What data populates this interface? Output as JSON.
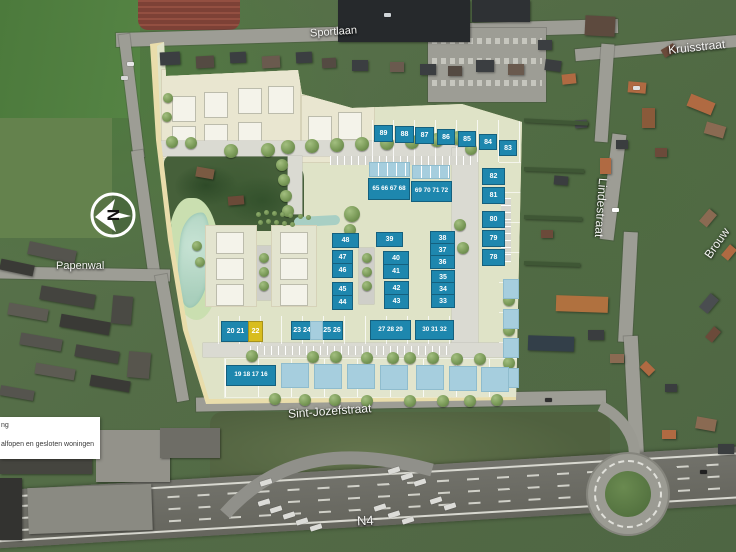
{
  "streets": {
    "sportlaan": "Sportlaan",
    "kruisstraat": "Kruisstraat",
    "lindestraat": "Lindestraat",
    "brouw": "Brouw",
    "papenwal": "Papenwal",
    "sint_jozefstraat": "Sint-Jozefstraat",
    "n4": "N4"
  },
  "north_arrow": {
    "letter": "N"
  },
  "legend": {
    "line1_partial": "ng",
    "line2_partial": "alfopen en gesloten woningen"
  },
  "colors": {
    "available": "#1e87ae",
    "option": "#d8bd1e",
    "reserved": "#a6cede",
    "plan_background": "#dfe3c7",
    "plan_border": "#e9ddab"
  },
  "lots": [
    {
      "label": "89",
      "status": "available",
      "x": 374,
      "y": 125,
      "w": 17,
      "h": 15
    },
    {
      "label": "88",
      "status": "available",
      "x": 395,
      "y": 126,
      "w": 17,
      "h": 15
    },
    {
      "label": "87",
      "status": "available",
      "x": 415,
      "y": 127,
      "w": 17,
      "h": 15
    },
    {
      "label": "86",
      "status": "available",
      "x": 437,
      "y": 129,
      "w": 16,
      "h": 14
    },
    {
      "label": "85",
      "status": "available",
      "x": 458,
      "y": 131,
      "w": 16,
      "h": 14
    },
    {
      "label": "84",
      "status": "available",
      "x": 479,
      "y": 134,
      "w": 16,
      "h": 14
    },
    {
      "label": "83",
      "status": "available",
      "x": 499,
      "y": 140,
      "w": 16,
      "h": 14
    },
    {
      "label": "82",
      "status": "available",
      "x": 482,
      "y": 168,
      "w": 21,
      "h": 15
    },
    {
      "label": "81",
      "status": "available",
      "x": 482,
      "y": 187,
      "w": 21,
      "h": 15
    },
    {
      "label": "80",
      "status": "available",
      "x": 482,
      "y": 211,
      "w": 21,
      "h": 15
    },
    {
      "label": "79",
      "status": "available",
      "x": 482,
      "y": 230,
      "w": 21,
      "h": 15
    },
    {
      "label": "78",
      "status": "available",
      "x": 482,
      "y": 249,
      "w": 21,
      "h": 15
    },
    {
      "label": "65 66 67 68",
      "status": "available",
      "x": 368,
      "y": 178,
      "w": 40,
      "h": 20
    },
    {
      "label": "69 70 71 72",
      "status": "available",
      "x": 411,
      "y": 181,
      "w": 39,
      "h": 19
    },
    {
      "label": "48",
      "status": "available",
      "x": 332,
      "y": 233,
      "w": 25,
      "h": 13
    },
    {
      "label": "39",
      "status": "available",
      "x": 376,
      "y": 232,
      "w": 25,
      "h": 13
    },
    {
      "label": "38",
      "status": "available",
      "x": 430,
      "y": 231,
      "w": 23,
      "h": 12
    },
    {
      "label": "37",
      "status": "available",
      "x": 430,
      "y": 243,
      "w": 23,
      "h": 12
    },
    {
      "label": "36",
      "status": "available",
      "x": 430,
      "y": 255,
      "w": 23,
      "h": 12
    },
    {
      "label": "47",
      "status": "available",
      "x": 332,
      "y": 250,
      "w": 19,
      "h": 13
    },
    {
      "label": "46",
      "status": "available",
      "x": 332,
      "y": 263,
      "w": 19,
      "h": 13
    },
    {
      "label": "40",
      "status": "available",
      "x": 383,
      "y": 251,
      "w": 24,
      "h": 13
    },
    {
      "label": "41",
      "status": "available",
      "x": 383,
      "y": 264,
      "w": 24,
      "h": 13
    },
    {
      "label": "45",
      "status": "available",
      "x": 332,
      "y": 282,
      "w": 19,
      "h": 13
    },
    {
      "label": "44",
      "status": "available",
      "x": 332,
      "y": 295,
      "w": 19,
      "h": 13
    },
    {
      "label": "42",
      "status": "available",
      "x": 384,
      "y": 281,
      "w": 23,
      "h": 13
    },
    {
      "label": "43",
      "status": "available",
      "x": 384,
      "y": 294,
      "w": 23,
      "h": 13
    },
    {
      "label": "35",
      "status": "available",
      "x": 431,
      "y": 270,
      "w": 22,
      "h": 12
    },
    {
      "label": "34",
      "status": "available",
      "x": 431,
      "y": 282,
      "w": 22,
      "h": 12
    },
    {
      "label": "33",
      "status": "available",
      "x": 431,
      "y": 294,
      "w": 22,
      "h": 12
    },
    {
      "label": "27 28 29",
      "status": "available",
      "x": 370,
      "y": 320,
      "w": 39,
      "h": 18
    },
    {
      "label": "30 31 32",
      "status": "available",
      "x": 415,
      "y": 320,
      "w": 37,
      "h": 18
    },
    {
      "label": "20 21",
      "status": "available",
      "x": 221,
      "y": 321,
      "w": 27,
      "h": 19
    },
    {
      "label": "22",
      "status": "option",
      "x": 248,
      "y": 321,
      "w": 13,
      "h": 19
    },
    {
      "label": "23 24",
      "status": "available",
      "x": 291,
      "y": 321,
      "w": 20,
      "h": 17
    },
    {
      "label": "25 26",
      "status": "available",
      "x": 321,
      "y": 321,
      "w": 20,
      "h": 17
    },
    {
      "label": "19 18 17 16",
      "status": "available",
      "x": 226,
      "y": 365,
      "w": 48,
      "h": 19
    },
    {
      "label": "",
      "status": "reserved",
      "x": 310,
      "y": 321,
      "w": 11,
      "h": 17
    },
    {
      "label": "",
      "status": "reserved",
      "x": 369,
      "y": 162,
      "w": 39,
      "h": 13,
      "divided": true
    },
    {
      "label": "",
      "status": "reserved",
      "x": 412,
      "y": 165,
      "w": 36,
      "h": 12,
      "divided": true
    },
    {
      "label": "",
      "status": "reserved",
      "x": 503,
      "y": 279,
      "w": 14,
      "h": 18
    },
    {
      "label": "",
      "status": "reserved",
      "x": 503,
      "y": 309,
      "w": 14,
      "h": 18
    },
    {
      "label": "",
      "status": "reserved",
      "x": 503,
      "y": 338,
      "w": 14,
      "h": 18
    },
    {
      "label": "",
      "status": "reserved",
      "x": 502,
      "y": 368,
      "w": 15,
      "h": 18
    },
    {
      "label": "",
      "status": "reserved",
      "x": 281,
      "y": 363,
      "w": 26,
      "h": 23
    },
    {
      "label": "",
      "status": "reserved",
      "x": 314,
      "y": 364,
      "w": 26,
      "h": 23
    },
    {
      "label": "",
      "status": "reserved",
      "x": 347,
      "y": 364,
      "w": 26,
      "h": 23
    },
    {
      "label": "",
      "status": "reserved",
      "x": 380,
      "y": 365,
      "w": 26,
      "h": 23
    },
    {
      "label": "",
      "status": "reserved",
      "x": 416,
      "y": 365,
      "w": 26,
      "h": 23
    },
    {
      "label": "",
      "status": "reserved",
      "x": 449,
      "y": 366,
      "w": 26,
      "h": 23
    },
    {
      "label": "",
      "status": "reserved",
      "x": 481,
      "y": 367,
      "w": 26,
      "h": 23
    }
  ]
}
